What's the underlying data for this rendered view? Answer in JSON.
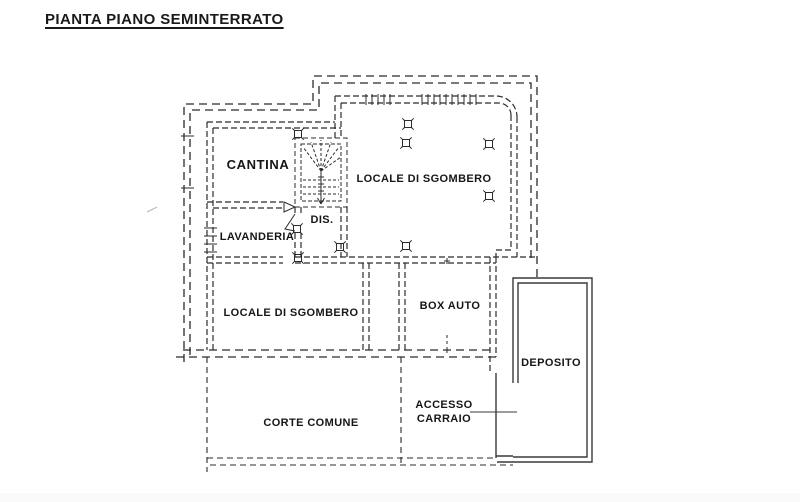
{
  "title": "PIANTA PIANO SEMINTERRATO",
  "colors": {
    "line": "#2b2b2b",
    "solid_line": "#3a3a3a",
    "text": "#161616",
    "background": "#ffffff"
  },
  "rooms": {
    "cantina": {
      "label": "CANTINA"
    },
    "lavanderia": {
      "label": "LAVANDERIA"
    },
    "dis": {
      "label": "DIS."
    },
    "locale_sgombero_upper": {
      "label": "LOCALE DI SGOMBERO"
    },
    "locale_sgombero_lower": {
      "label": "LOCALE DI SGOMBERO"
    },
    "box_auto": {
      "label": "BOX AUTO"
    },
    "deposito": {
      "label": "DEPOSITO"
    },
    "corte_comune": {
      "label": "CORTE COMUNE"
    },
    "accesso_carraio": {
      "label_line1": "ACCESSO",
      "label_line2": "CARRAIO"
    }
  }
}
